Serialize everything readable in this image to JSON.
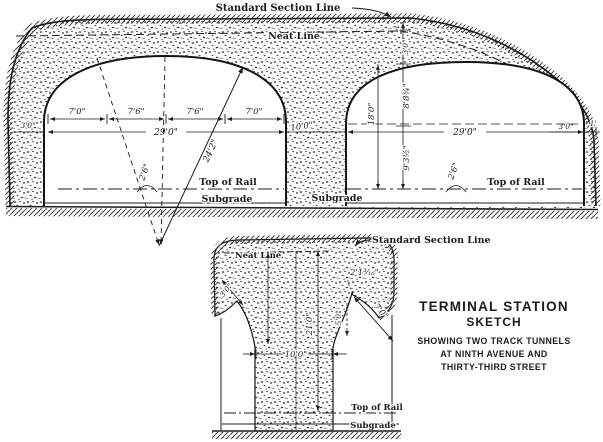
{
  "colors": {
    "ink": "#1c1c1c",
    "paper": "#ffffff"
  },
  "upper_section": {
    "standard_section_line_label": "Standard Section Line",
    "neat_line_label": "Neat Line",
    "top_of_rail_label": "Top of Rail",
    "subgrade_label": "Subgrade",
    "track_segment_dims": [
      "7'0\"",
      "7'6\"",
      "7'6\"",
      "7'0\""
    ],
    "tunnel_width_left": "29'0\"",
    "tunnel_width_right": "29'0\"",
    "pier_width": "10'0\"",
    "diagonal_dim": "24'2\"",
    "gauge_offset_left": "2'6\"",
    "gauge_offset_right": "2'6\"",
    "wall_thickness_left": "3'0\"",
    "wall_thickness_right": "3'0\"",
    "edge_offset_right": "1'",
    "surface_to_neat": "1'",
    "arch_ring": "3'0\"",
    "crown_to_springline": "8'8¾\"",
    "springline_to_rail": "9'3½\"",
    "crown_to_rail": "18'0\""
  },
  "lower_section": {
    "standard_section_line_label": "Standard Section Line",
    "neat_line_label": "Neat Line",
    "top_of_rail_label": "Top of Rail",
    "subgrade_label": "Subgrade",
    "corner_offset": "2'1³⁄₁₆\"",
    "ring_thickness": "3'0\"",
    "haunch_radius": "7'0\"",
    "drop_dim": "5'0\"",
    "pier_width": "10'0\"",
    "neat_to_rail_height": "21'0\""
  },
  "caption": {
    "line1": "TERMINAL STATION",
    "line2": "SKETCH",
    "line3": "SHOWING TWO TRACK TUNNELS",
    "line4": "AT NINTH AVENUE AND",
    "line5": "THIRTY-THIRD STREET"
  }
}
